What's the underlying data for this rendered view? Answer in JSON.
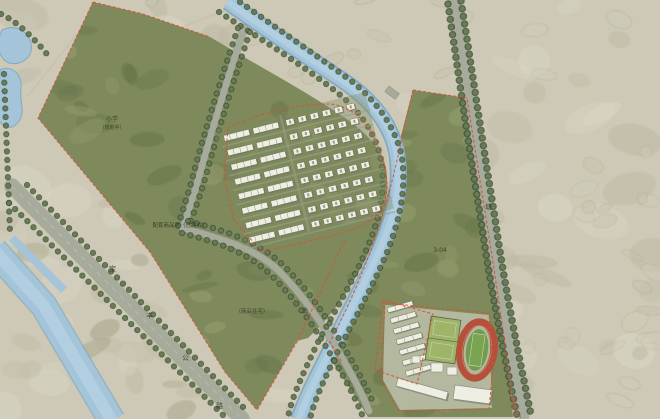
{
  "map": {
    "type": "residential-district-site-master-plan",
    "labels": {
      "parcel_a_line1": "小学",
      "parcel_a_line2": "（规划中）",
      "parcel_b": "配套商品房（已建成）",
      "parcel_c_code": "3-04",
      "parcel_d": "（商品住宅）",
      "road_b_char_1": "宝",
      "road_b_char_2": "丰",
      "road_b_char_3": "公",
      "road_b_char_4": "路",
      "road_c_char": "塘",
      "road_d_char": "南"
    },
    "features": [
      "park-green-parcel",
      "housing-estate",
      "school-campus",
      "running-track",
      "sports-courts",
      "winding-river",
      "straight-canal",
      "ponds",
      "tree-lined-avenue",
      "wide-diagonal-road",
      "eastern-road",
      "red-dashed-parcel-boundaries"
    ],
    "colors": {
      "bg": "#cdc9b6",
      "bg_light": "#dad6c5",
      "bg_dark": "#bcb8a2",
      "green": "#7e8a5c",
      "green_dark": "#66744a",
      "green_light": "#959e6e",
      "water": "#a3c4d9",
      "water_deep": "#84a9c0",
      "water_light": "#bfd9e7",
      "road": "#a6ab9b",
      "tree_ring": "#3e5038",
      "tree_fill": "#6a7f55",
      "red_line": "#d94e38",
      "building": "#efeee2",
      "building_shadow": "#6e7460",
      "track": "#b5503a",
      "field": "#719e4e",
      "court": "#9eb468",
      "label": "#2c331f"
    }
  }
}
